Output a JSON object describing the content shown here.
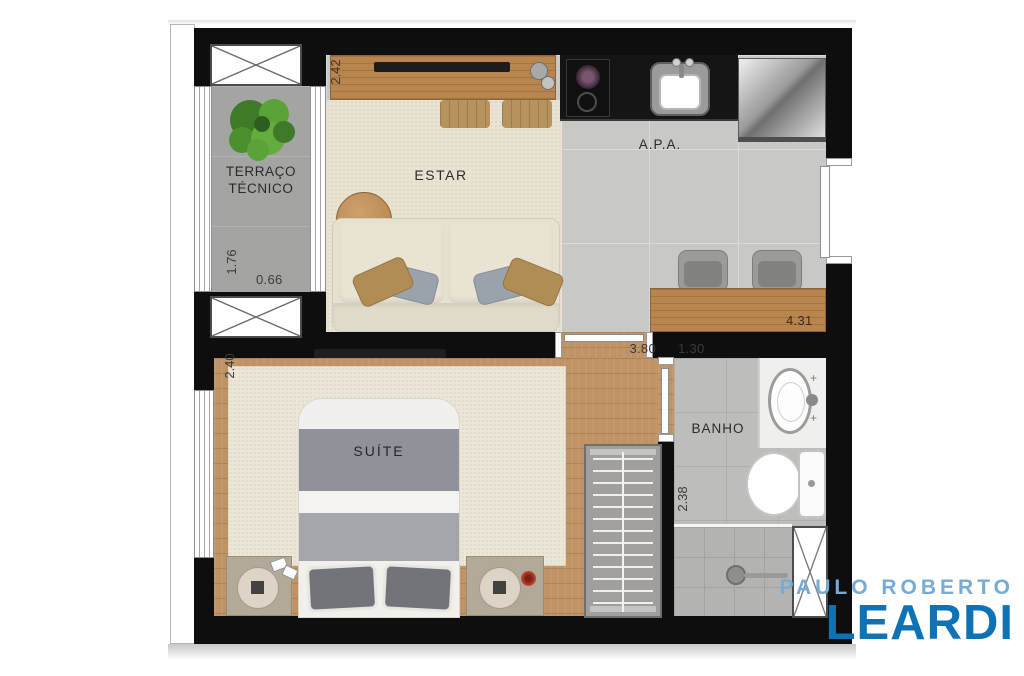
{
  "plan": {
    "rooms": {
      "terraco": {
        "name_line1": "TERRAÇO",
        "name_line2": "TÉCNICO",
        "dim_depth": "1.76",
        "dim_width": "0.66"
      },
      "estar": {
        "name": "ESTAR",
        "dim_depth": "2.42"
      },
      "apa": {
        "name": "A.P.A.",
        "dim_width": "4.31"
      },
      "suite": {
        "name": "SUÍTE",
        "dim_depth": "2.40",
        "dim_hall_width": "3.80"
      },
      "banho": {
        "name": "BANHO",
        "dim_width": "1.30",
        "dim_depth": "2.38"
      }
    },
    "fixtures": [
      "plant",
      "tv",
      "sideboard",
      "sofa",
      "coffee-table",
      "poufs",
      "cooktop",
      "kitchen-sink",
      "fridge",
      "breakfast-counter",
      "stools",
      "entrance-door",
      "double-bed",
      "nightstands",
      "wardrobe",
      "washbasin",
      "toilet",
      "shower-drain",
      "shaft-hatch"
    ],
    "colors": {
      "wall": "#0e0e0e",
      "wood_floor": "#c09365",
      "kitchen_tile": "#c8c8c6",
      "carpet": "#eae3d4",
      "bath_tile": "#bdbdbb",
      "terrace_floor": "#a4a5a3",
      "plant_green": "#4e8f31"
    }
  },
  "brand": {
    "line1": "PAULO ROBERTO",
    "line2": "LEARDI",
    "color_line1": "#76abd5",
    "color_line2": "#0e73b4"
  }
}
